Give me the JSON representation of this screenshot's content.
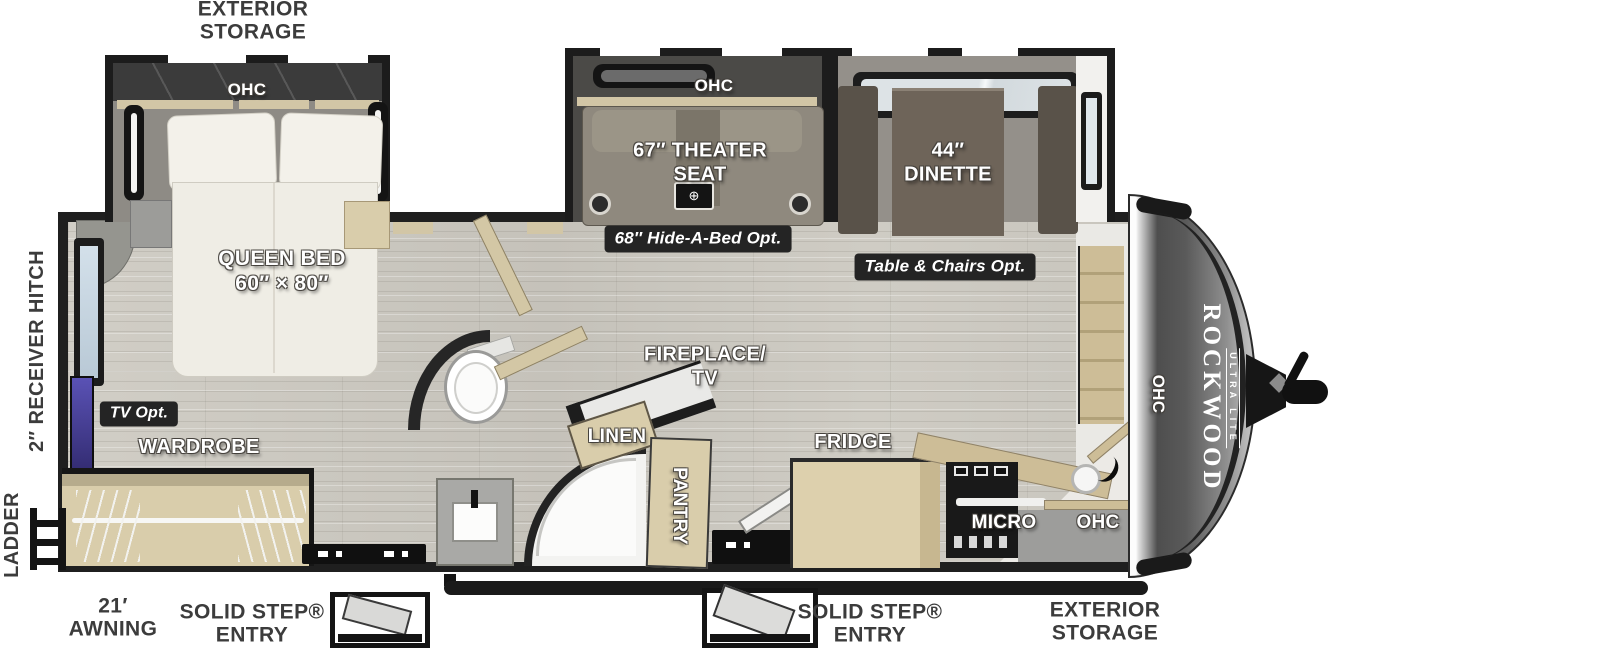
{
  "title": "Rockwood Ultra Lite travel trailer floor plan",
  "colors": {
    "wall": "#1f1f1f",
    "floor_wood": "#cbc8c0",
    "cabinet_wood": "#d9cdab",
    "badge_background": "#242424",
    "interior_label_text": "#ffffff",
    "exterior_label_text": "#3c3c3c",
    "nose_cap_gray": "#4a4a4a",
    "tv_accent_blue": "#4a3f9e",
    "window_glass": "#cfdde8"
  },
  "labels": {
    "exterior_storage_top": {
      "line1": "EXTERIOR",
      "line2": "STORAGE"
    },
    "bedroom_ohc": "OHC",
    "queen_bed": {
      "line1": "QUEEN BED",
      "line2": "60″ × 80″"
    },
    "theater_ohc": "OHC",
    "theater_seat": {
      "line1": "67″ THEATER",
      "line2": "SEAT"
    },
    "hide_a_bed_option": "68″ Hide-A-Bed Opt.",
    "dinette": {
      "line1": "44″",
      "line2": "DINETTE"
    },
    "table_chairs_option": "Table & Chairs Opt.",
    "receiver_hitch": "2″ RECEIVER HITCH",
    "ladder": "LADDER",
    "tv_option": "TV Opt.",
    "wardrobe": "WARDROBE",
    "fireplace_tv": {
      "line1": "FIREPLACE/",
      "line2": "TV"
    },
    "linen": "LINEN",
    "pantry": "PANTRY",
    "fridge": "FRIDGE",
    "micro": "MICRO",
    "kitchen_ohc": "OHC",
    "front_ohc": "OHC",
    "brand": {
      "name": "ROCKWOOD",
      "sub": "ULTRA LITE"
    },
    "awning": {
      "line1": "21′",
      "line2": "AWNING"
    },
    "solid_step_entry_left": {
      "line1": "SOLID STEP®",
      "line2": "ENTRY"
    },
    "solid_step_entry_right": {
      "line1": "SOLID STEP®",
      "line2": "ENTRY"
    },
    "exterior_storage_bottom": {
      "line1": "EXTERIOR",
      "line2": "STORAGE"
    }
  },
  "icons": {
    "theater_console": "⊕"
  }
}
